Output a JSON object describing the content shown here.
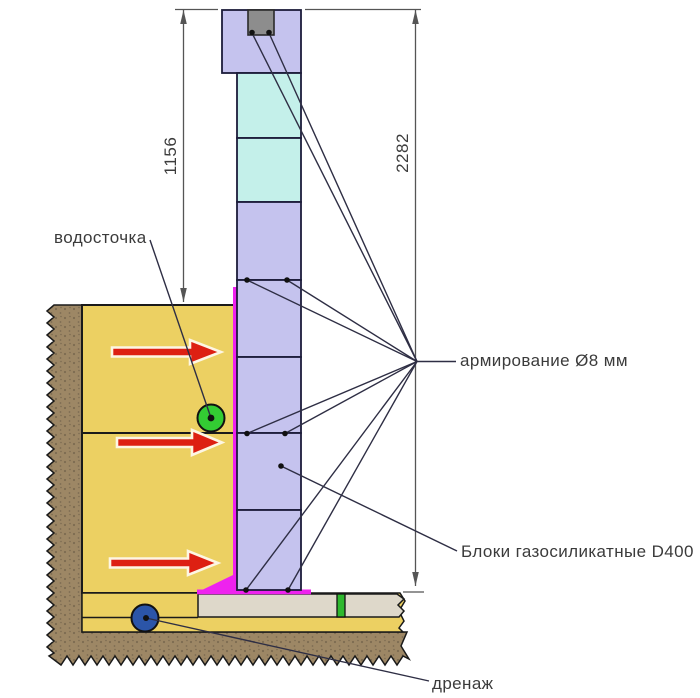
{
  "diagram": {
    "type": "construction-wall-section",
    "labels": {
      "downspout": "водосточка",
      "reinforcement": "армирование Ø8 мм",
      "blocks": "Блоки газосиликатные D400",
      "drainage": "дренаж"
    },
    "dimensions": {
      "above_ground_height": "1156",
      "total_height": "2282"
    }
  },
  "colors": {
    "block_lavender": "#c5c3ee",
    "block_cyan": "#c4f0ea",
    "anchor_gray": "#8d8d8d",
    "soil_yellow": "#ecd062",
    "soil_brown": "#9d8765",
    "soil_brown_speck": "#7c6b51",
    "slab_beige": "#ded8ca",
    "waterproofing_magenta": "#ee22ee",
    "arrow_red": "#dd2012",
    "downspout_green": "#33cc33",
    "drainage_blue": "#2b55a8",
    "dpc_green": "#2eb82e"
  }
}
